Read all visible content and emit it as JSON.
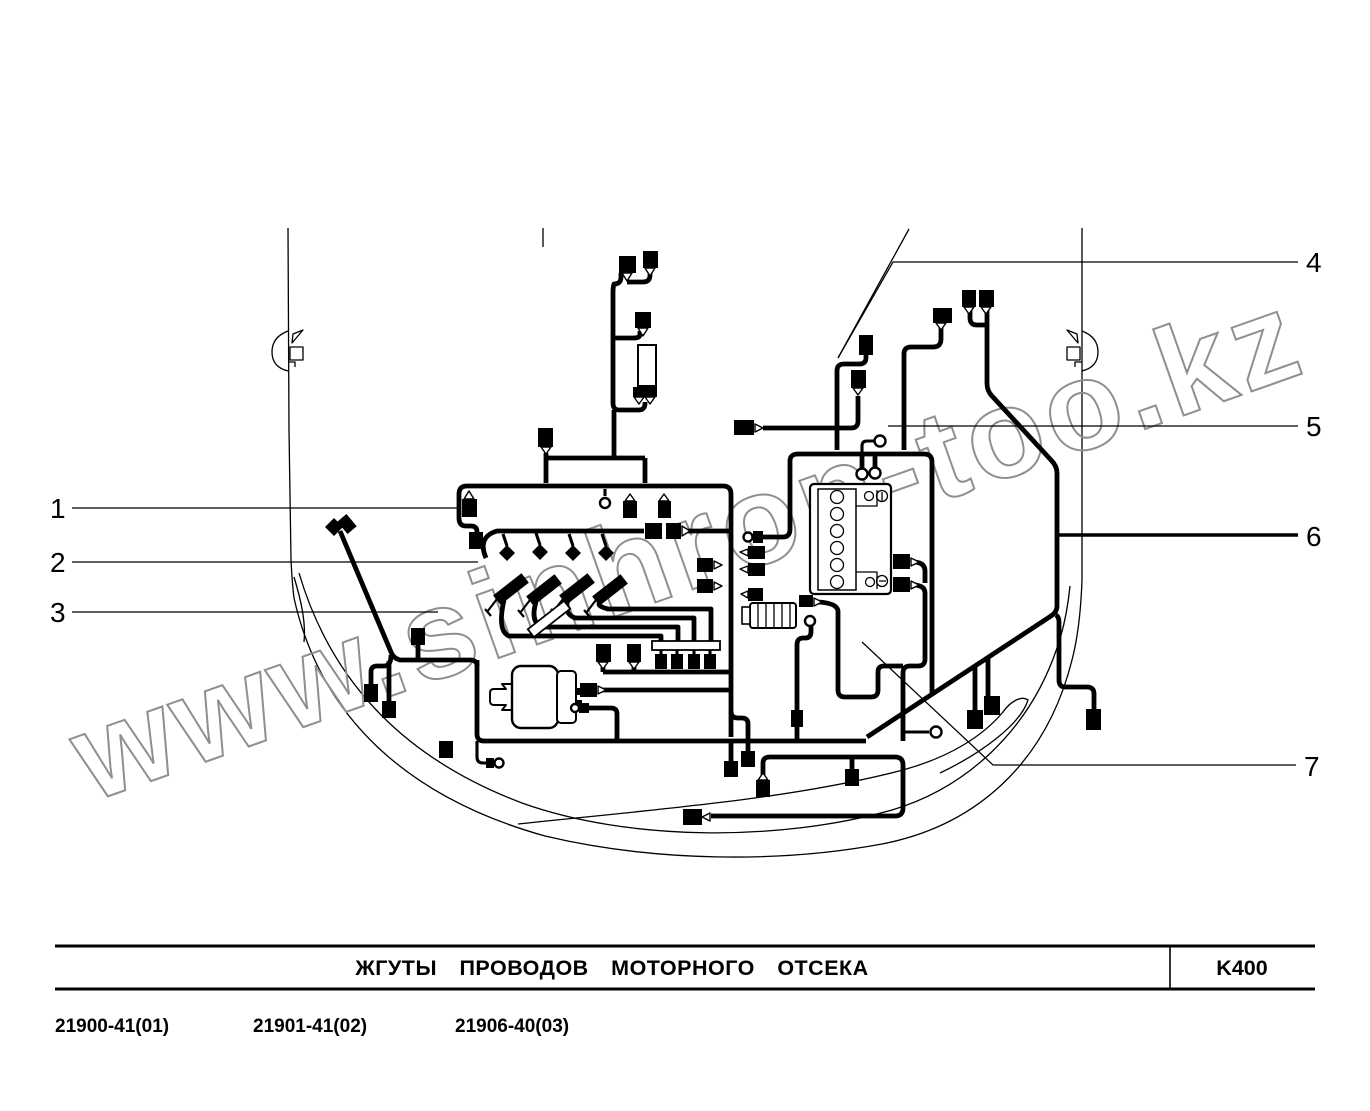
{
  "watermark": {
    "text": "www.sinhron-too.kz"
  },
  "callouts": [
    "1",
    "2",
    "3",
    "4",
    "5",
    "6",
    "7"
  ],
  "title_block": {
    "title": "ЖГУТЫ ПРОВОДОВ МОТОРНОГО ОТСЕКА",
    "code": "K400",
    "part_numbers": [
      "21900-41(01)",
      "21901-41(02)",
      "21906-40(03)"
    ]
  }
}
